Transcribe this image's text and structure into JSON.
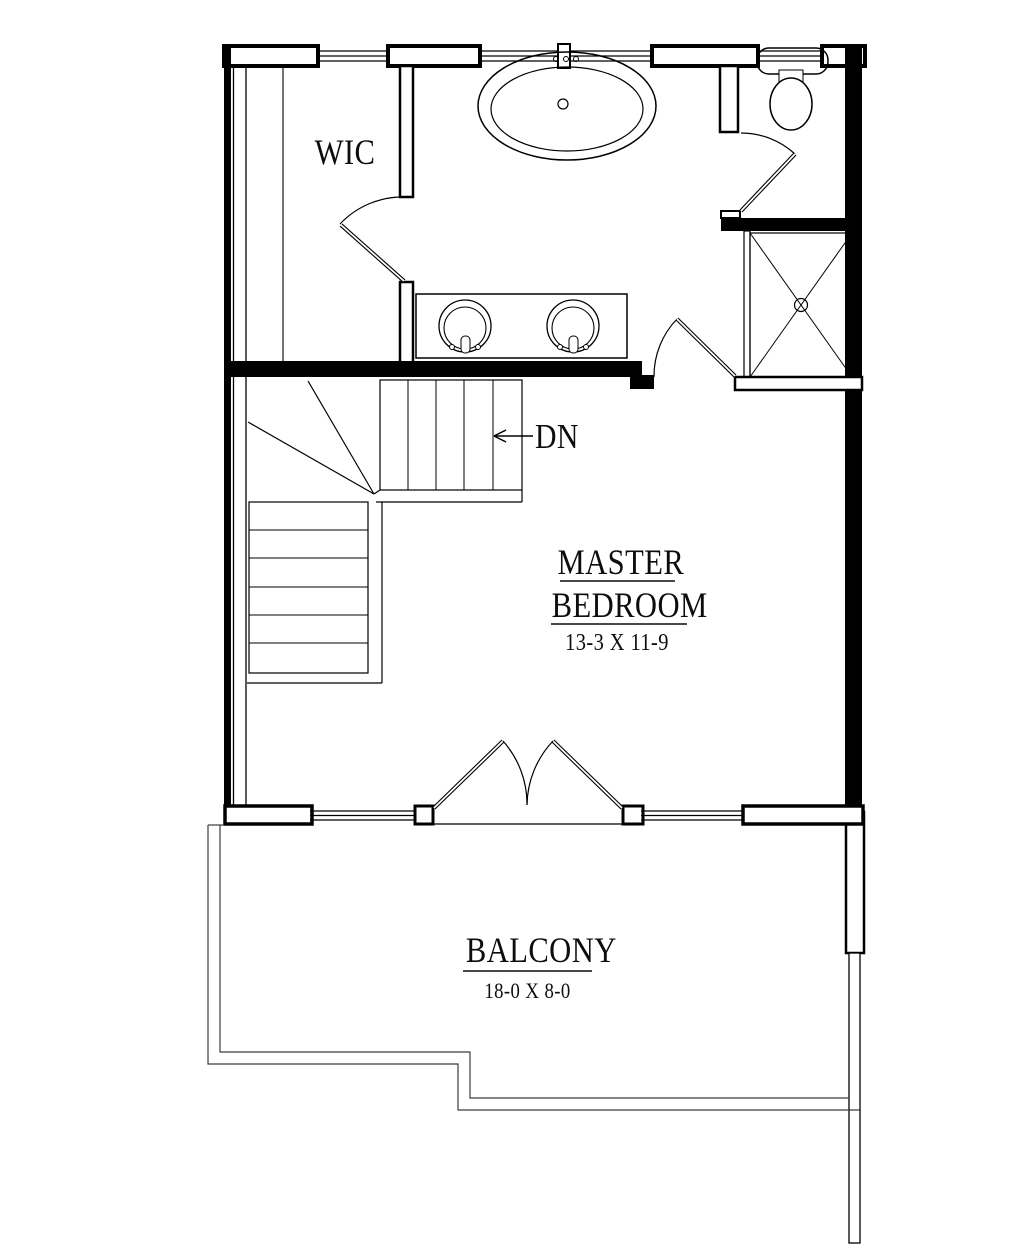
{
  "rooms": {
    "wic": {
      "label": "WIC"
    },
    "master_bedroom": {
      "label_line1": "MASTER",
      "label_line2": "BEDROOM",
      "dimensions": "13-3 X 11-9"
    },
    "balcony": {
      "label": "BALCONY",
      "dimensions": "18-0 X 8-0"
    }
  },
  "stairs": {
    "direction_label": "DN"
  },
  "fixtures": {
    "tub": "oval-bathtub",
    "toilet": "toilet",
    "vanity": "double-sink-vanity",
    "shower": "shower-with-drain",
    "stairs": "winder-staircase",
    "doors": "swing-doors-and-french-doors"
  },
  "colors": {
    "background": "#ffffff",
    "wall_line": "#000000",
    "balcony_line": "#3c3c3c"
  }
}
